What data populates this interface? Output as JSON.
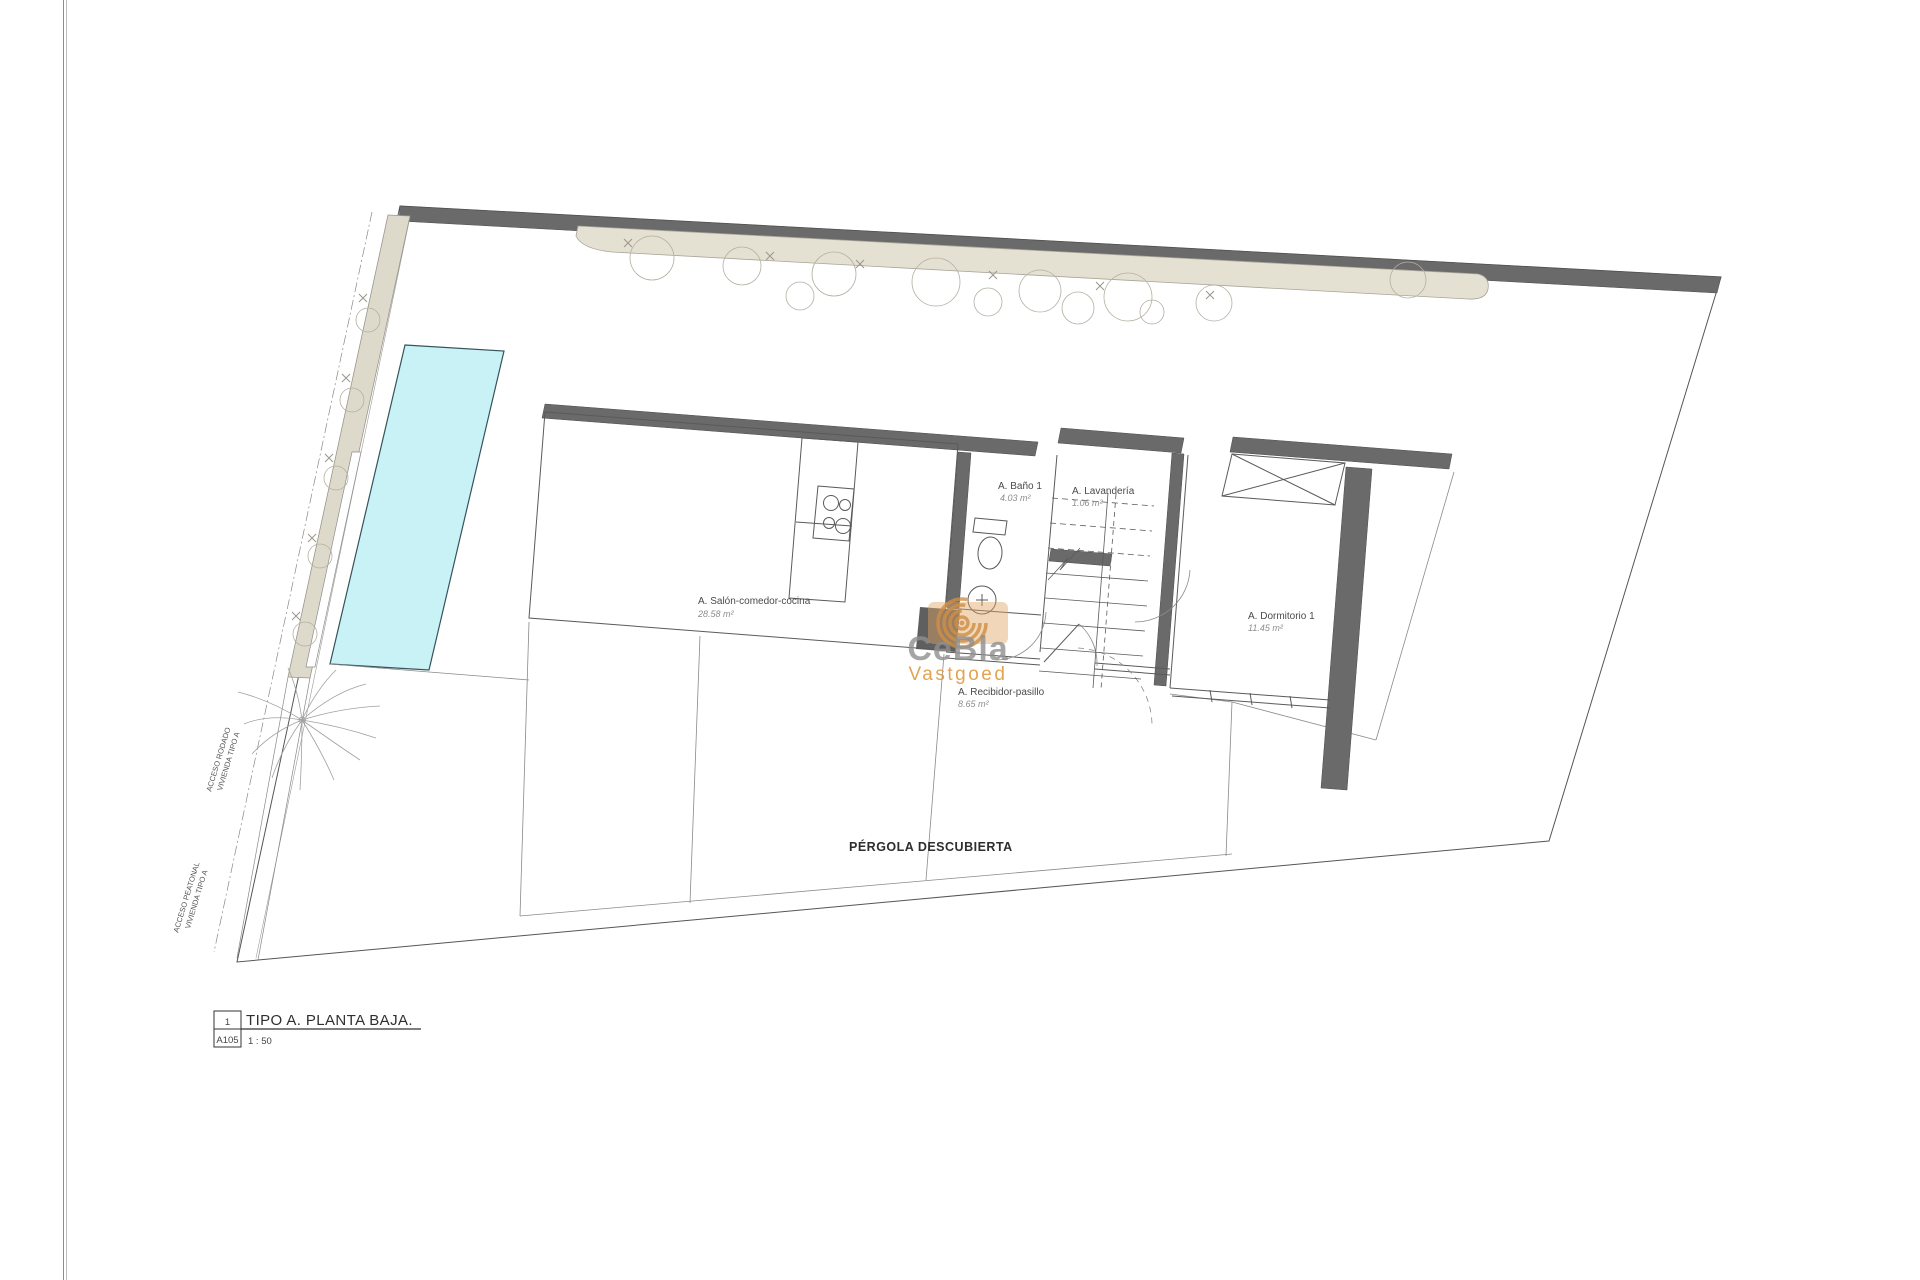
{
  "drawing": {
    "rooms": [
      {
        "name": "A. Salón-comedor-cocina",
        "area": "28.58 m²"
      },
      {
        "name": "A. Baño 1",
        "area": "4.03 m²"
      },
      {
        "name": "A. Lavandería",
        "area": "1.06 m²"
      },
      {
        "name": "A. Dormitorio 1",
        "area": "11.45 m²"
      },
      {
        "name": "A. Recibidor-pasillo",
        "area": "8.65 m²"
      }
    ],
    "site": {
      "pergola_label": "PÉRGOLA DESCUBIERTA",
      "access_road_line1": "ACCESO RODADO",
      "access_road_line2": "VIVIENDA TIPO A",
      "access_ped_line1": "ACCESO PEATONAL",
      "access_ped_line2": "VIVIENDA TIPO A"
    },
    "title_block": {
      "number": "1",
      "sheet": "A105",
      "title": "TIPO A. PLANTA BAJA.",
      "scale": "1 : 50"
    },
    "watermark": {
      "brand": "CeBla",
      "sub": "Vastgoed"
    },
    "colors": {
      "wall": "#6a6a6a",
      "pool": "#c9f2f6",
      "vegetation": "#e4e0d2",
      "watermark_arcs": "#cf8f45",
      "watermark_sub": "#e19a3e"
    }
  }
}
